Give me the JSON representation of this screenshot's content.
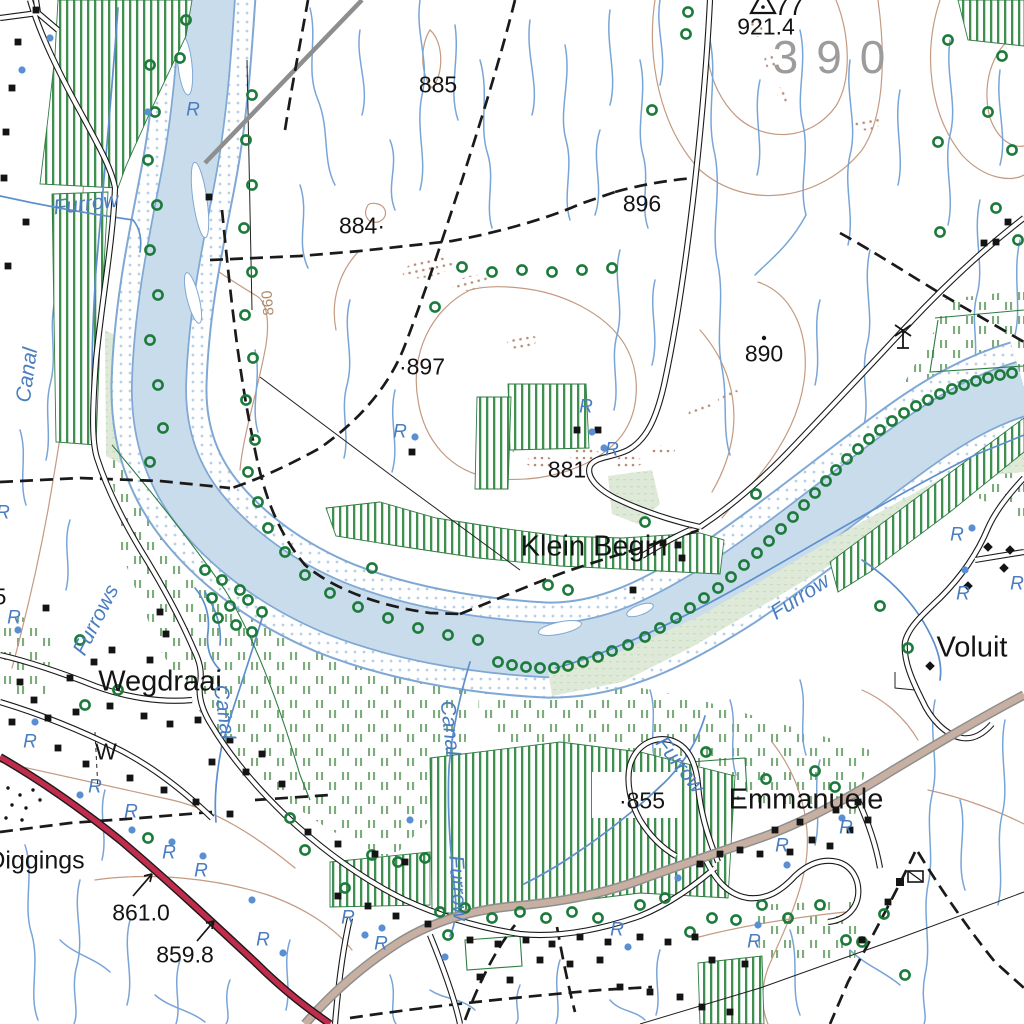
{
  "map_title": "Topographic map extract (1:50 000 style)",
  "colors": {
    "water_fill": "#c9dcec",
    "water_line": "#6f9fd0",
    "stream": "#78a5d8",
    "sand_dot": "#b7cfe8",
    "contour": "#c49a82",
    "erosion": "#b98c74",
    "cultivated_stripe": "#3f8f50",
    "field_border": "#2e7d42",
    "sparse_dash": "#7cab7c",
    "marsh": "#dfe9d8",
    "tree": "#1c7a3a",
    "road_red": "#c22c4c",
    "road_tan": "#c7b0a2",
    "road_casing": "#1a1a1a",
    "power_line": "#8e8e8e",
    "grid_gray": "#9c9c9c",
    "hydro_label": "#4a7ec0",
    "contour_label": "#b08968"
  },
  "symbols": {
    "tree_icon": {
      "meaning": "tree / bush",
      "color": "#1c7a3a"
    },
    "building_icon": {
      "meaning": "building",
      "color": "#141414"
    },
    "water_point_icon": {
      "meaning": "water point / well",
      "color": "#5b8fd4"
    },
    "windpump_icon": {
      "meaning": "windpump"
    },
    "trig_beacon_icon": {
      "meaning": "trigonometrical beacon"
    },
    "flag_building_icon": {
      "meaning": "public building with flag"
    },
    "diggings_icon": {
      "meaning": "diggings (black dotted area)"
    }
  },
  "labels": {
    "places": [
      {
        "text": "Wegdraai",
        "x": 160,
        "y": 682,
        "cls": "place"
      },
      {
        "text": "Klein Begin",
        "x": 594,
        "y": 547,
        "cls": "place"
      },
      {
        "text": "Emmanuele",
        "x": 806,
        "y": 800,
        "cls": "place"
      },
      {
        "text": "Voluit",
        "x": 972,
        "y": 648,
        "cls": "place"
      },
      {
        "text": "Diggings",
        "x": 36,
        "y": 861,
        "cls": "place-sm"
      }
    ],
    "spot_heights": [
      {
        "text": "921.4",
        "x": 766,
        "y": 27
      },
      {
        "text": "885",
        "x": 438,
        "y": 85
      },
      {
        "text": "884·",
        "x": 362,
        "y": 226
      },
      {
        "text": "896",
        "x": 642,
        "y": 204
      },
      {
        "text": "·897",
        "x": 422,
        "y": 367
      },
      {
        "text": "890",
        "x": 764,
        "y": 354
      },
      {
        "text": "881",
        "x": 567,
        "y": 470
      },
      {
        "text": "·855",
        "x": 642,
        "y": 801
      },
      {
        "text": "861.0",
        "x": 141,
        "y": 913
      },
      {
        "text": "859.8",
        "x": 185,
        "y": 955
      },
      {
        "text": "5",
        "x": 0,
        "y": 597
      }
    ],
    "beacon_number": {
      "text": "77",
      "x": 789,
      "y": 6
    },
    "grid_label": {
      "text": "390",
      "x": 838,
      "y": 57
    },
    "contour_label": {
      "text": "860",
      "x": 268,
      "y": 303,
      "rot": -95
    },
    "windpump_label": {
      "text": "W",
      "x": 106,
      "y": 752
    },
    "hydro": [
      {
        "text": "Furrow",
        "x": 86,
        "y": 204,
        "rot": -7
      },
      {
        "text": "Canal",
        "x": 27,
        "y": 375,
        "rot": -82
      },
      {
        "text": "Furrows",
        "x": 96,
        "y": 620,
        "rot": -63
      },
      {
        "text": "Canal",
        "x": 224,
        "y": 712,
        "rot": 82
      },
      {
        "text": "Canal",
        "x": 450,
        "y": 728,
        "rot": 84
      },
      {
        "text": "Furrow",
        "x": 458,
        "y": 888,
        "rot": 86
      },
      {
        "text": "Furrow",
        "x": 680,
        "y": 765,
        "rot": 52
      },
      {
        "text": "Furrow",
        "x": 800,
        "y": 597,
        "rot": -33
      }
    ],
    "water_marks": [
      {
        "text": "R",
        "x": 193,
        "y": 110
      },
      {
        "text": "R",
        "x": 400,
        "y": 432
      },
      {
        "text": "R",
        "x": 586,
        "y": 407
      },
      {
        "text": "R",
        "x": 612,
        "y": 450
      },
      {
        "text": "R",
        "x": 957,
        "y": 535
      },
      {
        "text": "R",
        "x": 963,
        "y": 594
      },
      {
        "text": "R",
        "x": 3,
        "y": 513
      },
      {
        "text": "R",
        "x": 14,
        "y": 618
      },
      {
        "text": "R",
        "x": 30,
        "y": 742
      },
      {
        "text": "R",
        "x": 95,
        "y": 787
      },
      {
        "text": "R",
        "x": 131,
        "y": 812
      },
      {
        "text": "R",
        "x": 169,
        "y": 853
      },
      {
        "text": "R",
        "x": 201,
        "y": 871
      },
      {
        "text": "R",
        "x": 263,
        "y": 940
      },
      {
        "text": "R",
        "x": 348,
        "y": 918
      },
      {
        "text": "R",
        "x": 381,
        "y": 944
      },
      {
        "text": "R",
        "x": 617,
        "y": 930
      },
      {
        "text": "R",
        "x": 754,
        "y": 942
      },
      {
        "text": "R",
        "x": 846,
        "y": 828
      },
      {
        "text": "R",
        "x": 782,
        "y": 846
      },
      {
        "text": "R",
        "x": 1017,
        "y": 584
      }
    ]
  }
}
